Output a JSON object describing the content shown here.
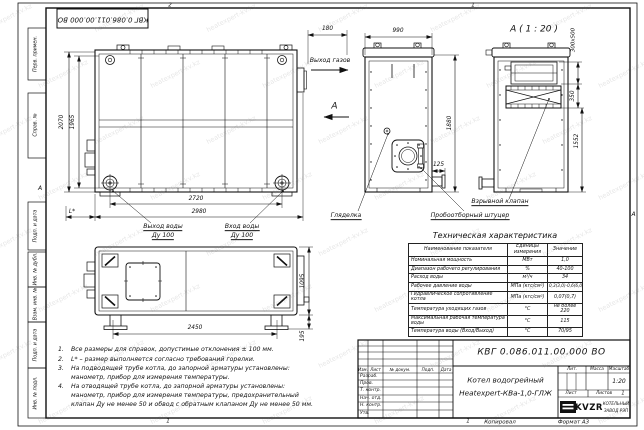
{
  "watermark": {
    "text": "heatexpert-kv.kz"
  },
  "stamp_top": "КВГ 0.086.011.00.000 ВО",
  "frame": {
    "left_labels": [
      "Перв. примен.",
      "Справ. №",
      "Подп. и дата",
      "Инв. № дубл.",
      "Взам. инв. №",
      "Подп. и дата",
      "Инв. № подл."
    ],
    "zones": {
      "top_left": "2",
      "top_right": "1",
      "bottom_left": "1",
      "bottom_right": "1",
      "side_left": "А",
      "side_right": "А"
    },
    "copied": "Копировал",
    "format": "Формат А3"
  },
  "dims": {
    "front_height": "2070",
    "front_height_inner": "1965",
    "front_width_inner": "2720",
    "front_width": "2980",
    "l_star": "L*",
    "gas_offset": "180",
    "side_width": "990",
    "side_height": "1880",
    "side_stub": "125",
    "valve_size": "300х500",
    "valve_offset": "350",
    "detail_height": "1552",
    "plan_width": "2450",
    "plan_depth": "1095",
    "plan_feet": "195"
  },
  "labels": {
    "gas_out": "Выход газов",
    "section_a": "А",
    "detail_title": "А ( 1 : 20 )",
    "water_out_line1": "Выход воды",
    "water_out_line2": "Ду 100",
    "water_in_line1": "Вход воды",
    "water_in_line2": "Ду 100",
    "sight_glass": "Гляделка",
    "probe": "Пробоотборный штуцер",
    "explosion_valve": "Взрывной клапан"
  },
  "notes": [
    {
      "num": "1.",
      "lines": [
        "Все размеры для справок, допустимые отклонения ± 100 мм."
      ]
    },
    {
      "num": "2.",
      "lines": [
        "L* – размер выполняется согласно требований горелки."
      ]
    },
    {
      "num": "3.",
      "lines": [
        "На подводящей трубе котла, до запорной арматуры установлены:",
        "манометр, прибор для измерения температуры."
      ]
    },
    {
      "num": "4.",
      "lines": [
        "На отводящей трубе котла, до запорной арматуры установлены:",
        "манометр, прибор для измерения температуры, предохранительный",
        "клапан Ду не менее 50 и обвод с обратным клапаном Ду не менее 50 мм."
      ]
    }
  ],
  "tech_table": {
    "title": "Техническая характеристика",
    "col_name": "Наименование показателя",
    "col_unit": "Единицы измерения",
    "col_value": "Значение",
    "rows": [
      [
        "Номинальная мощность",
        "МВт",
        "1,0"
      ],
      [
        "Диапазон рабочего регулирования",
        "%",
        "40-100"
      ],
      [
        "Расход воды",
        "м³/ч",
        "34"
      ],
      [
        "Рабочее давление воды",
        "МПа (кгс/см²)",
        "0,3(3,0)-0,6(6,0)"
      ],
      [
        "Гидравлическое сопротивление котла",
        "МПа (кгс/см²)",
        "0,07(0,7)"
      ],
      [
        "Температура уходящих газов",
        "°С",
        "не более 220"
      ],
      [
        "Максимальная рабочая температура воды",
        "°С",
        "115"
      ],
      [
        "Температура воды (Вход/Выход)",
        "°С",
        "70/95"
      ]
    ]
  },
  "title_block": {
    "doc_number": "КВГ 0.086.011.00.000 ВО",
    "product_line1": "Котел водогрейный",
    "product_line2": "Heatexpert-КВа-1,0-ГЛЖ",
    "cols": [
      "Изм.",
      "Лист",
      "№ докум.",
      "Подп.",
      "Дата"
    ],
    "roles": [
      "Разраб.",
      "Пров.",
      "Т. контр.",
      "Нач. отд.",
      "Н. контр.",
      "Утв."
    ],
    "lit_label": "Лит.",
    "mass_label": "Масса",
    "scale_label": "Масштаб",
    "scale_value": "1:20",
    "sheet_label": "Лист",
    "sheets_label": "Листов",
    "sheets_value": "1",
    "logo_text": "KVZR",
    "company_line1": "КОТЕЛЬНЫЙ",
    "company_line2": "ЗАВОД РЭП"
  }
}
